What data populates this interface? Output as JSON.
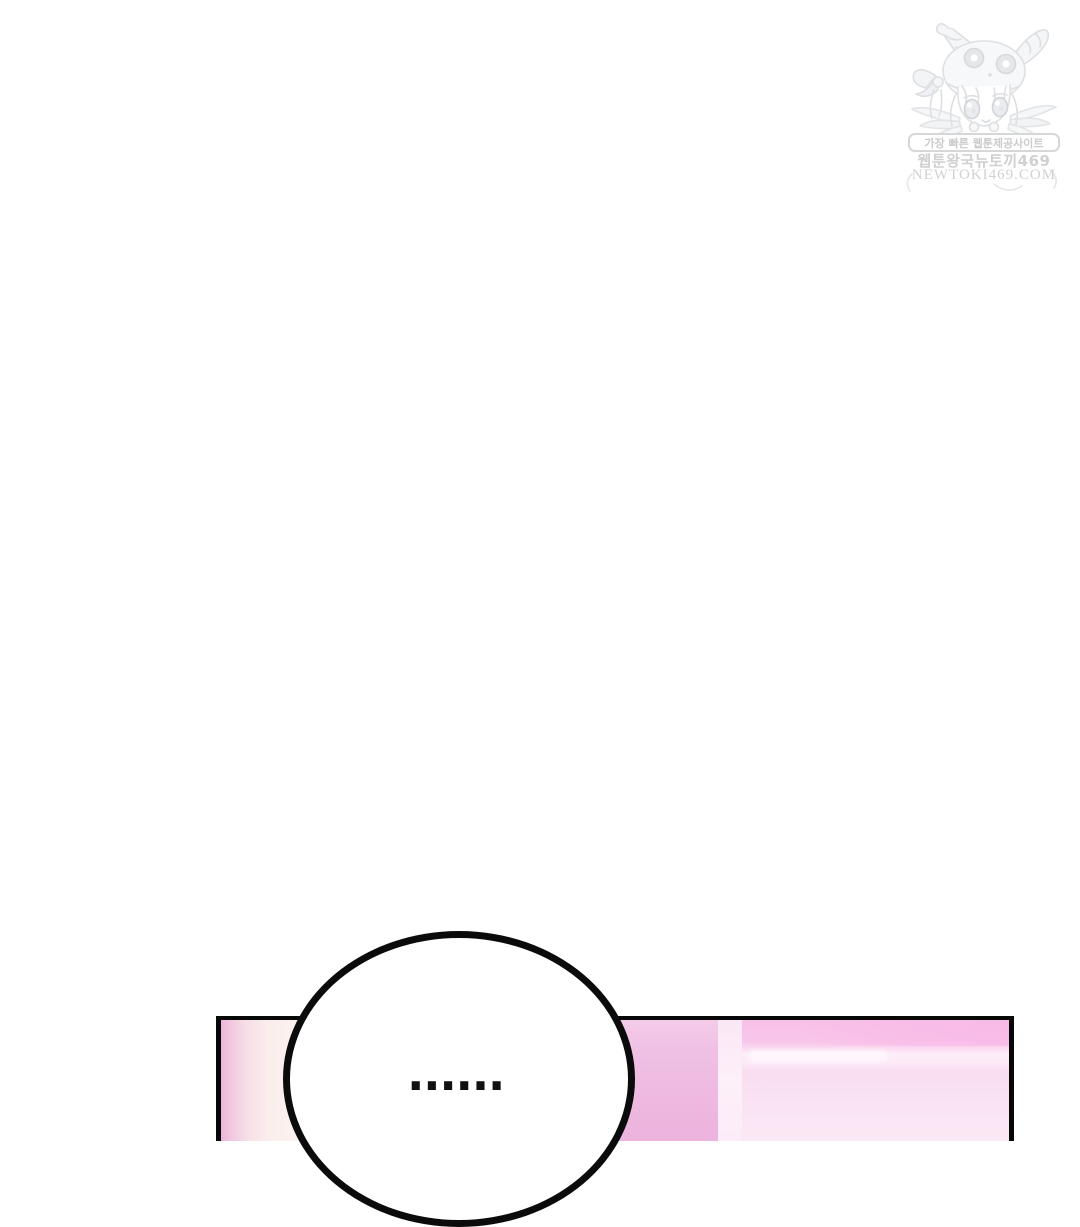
{
  "page": {
    "background": "#ffffff",
    "width_px": 1080,
    "height_px": 1125
  },
  "watermark": {
    "tagline": "가장 빠른 웹툰제공사이트",
    "site_name": "웹툰왕국뉴토끼469",
    "domain": "NEWTOKI469.COM",
    "text_color": "#d0d0d0",
    "mascot": "chibi-girl-bunny-hood-mascot"
  },
  "speech_bubble": {
    "text": "......",
    "fill": "#ffffff",
    "border_color": "#0b0b0b"
  },
  "panel": {
    "border_color": "#070707",
    "colors": {
      "left_strip_pink": "#ecb4d9",
      "left_strip_cream": "#fbf2ef",
      "mid_block_pink": "#efbce2",
      "divider_stripe": "#fdf0f9",
      "right_top_band": "#f8c0e8",
      "right_light_stripe": "#fdeef9",
      "right_body_pink": "#fae5f4"
    }
  }
}
